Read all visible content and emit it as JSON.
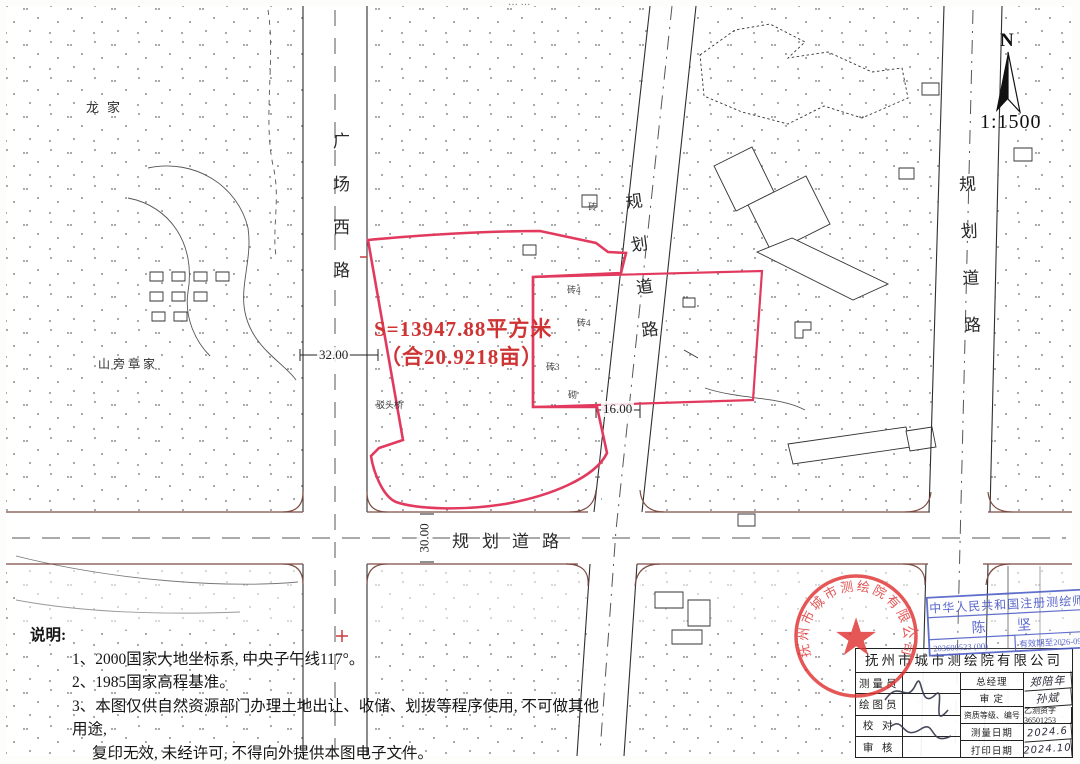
{
  "map": {
    "parcel": {
      "area_line1": "S=13947.88平方米",
      "area_line2": "（合20.9218亩）"
    },
    "roads": {
      "west": "广场西路",
      "diagonal": "规划道路",
      "right": "规划道路",
      "bottom": "规划道路"
    },
    "dimensions": {
      "west_road_width": "32.00",
      "diagonal_road_width": "16.00",
      "bottom_road_width": "30.00"
    },
    "places": {
      "longjia": "龙家",
      "shanpang": "山旁章家",
      "bridge": "驳头桥"
    },
    "buildings": [
      "砖4",
      "砖4",
      "砖3",
      "砌",
      "砖"
    ],
    "north": {
      "label": "N",
      "scale": "1:1500"
    }
  },
  "notes": {
    "title": "说明:",
    "items": [
      "1、2000国家大地坐标系, 中央子午线117°。",
      "2、1985国家高程基准。",
      "3、本图仅供自然资源部门办理土地出让、收储、划拨等程序使用, 不可做其他用途,",
      "复印无效, 未经许可, 不得向外提供本图电子文件。"
    ]
  },
  "seals": {
    "round_stamp_text": "抚州市城市测绘院有限公司",
    "star": "★",
    "surveyor_stamp": {
      "title": "中华人民共和国注册测绘师",
      "name": "陈  坚",
      "number": "203600523 (00)",
      "valid": "有效期至2026-09"
    }
  },
  "title_block": {
    "company": "抚州市城市测绘院有限公司",
    "left_rows": [
      "测量员",
      "绘图员",
      "校 对",
      "审 核"
    ],
    "right_rows": [
      {
        "label": "总经理",
        "value": "郑陪年"
      },
      {
        "label": "审 定",
        "value": "孙斌"
      },
      {
        "label": "资质等级、编号",
        "value": "乙测资字36501253"
      },
      {
        "label": "测量日期",
        "value": "2024.6"
      },
      {
        "label": "打印日期",
        "value": "2024.10"
      }
    ]
  }
}
